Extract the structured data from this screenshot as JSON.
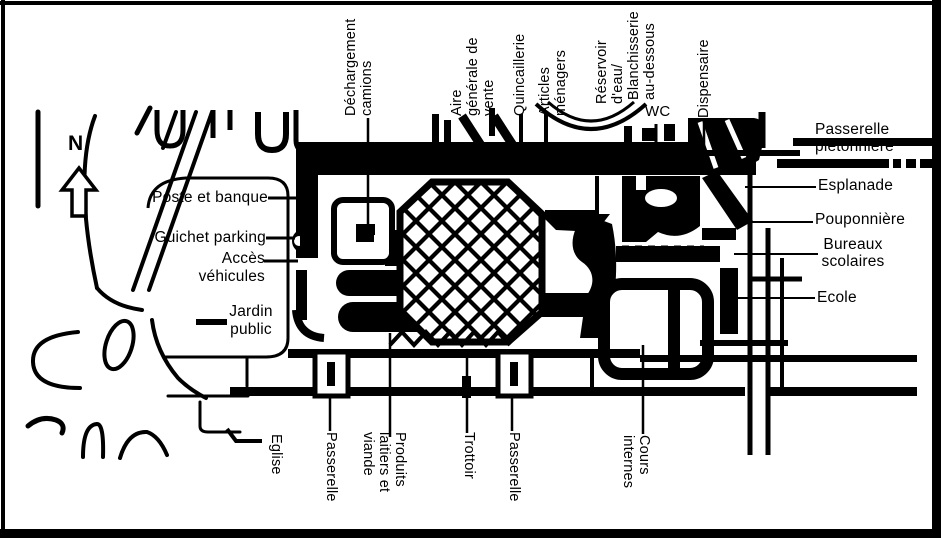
{
  "colors": {
    "ink": "#000000",
    "paper": "#ffffff"
  },
  "compass": {
    "north": "N"
  },
  "labels": {
    "dechargement": "Déchargement\ncamions",
    "aire": "Aire\ngénérale de\nvente",
    "quincaillerie": "Quincaillerie",
    "articles": "Articles\nménagers",
    "reservoir": "Réservoir\nd'eau/",
    "blanchisserie": "Blanchisserie\nau-dessous",
    "wc": "WC",
    "dispensaire": "Dispensaire",
    "passerelle_pietonniere": "Passerelle\npiétonnière",
    "esplanade": "Esplanade",
    "pouponniere": "Pouponnière",
    "bureaux_scolaires": "Bureaux\nscolaires",
    "ecole": "Ecole",
    "poste_banque": "Poste et banque",
    "guichet_parking": "Guichet parking",
    "acces_vehicules": "Accès\nvéhicules",
    "jardin_public": "Jardin\npublic",
    "eglise": "Eglise",
    "passerelle_ouest": "Passerelle",
    "produits": "Produits\nlaitiers et\nviande",
    "trottoir": "Trottoir",
    "passerelle_est": "Passerelle",
    "cours_internes": "Cours\ninternes"
  }
}
